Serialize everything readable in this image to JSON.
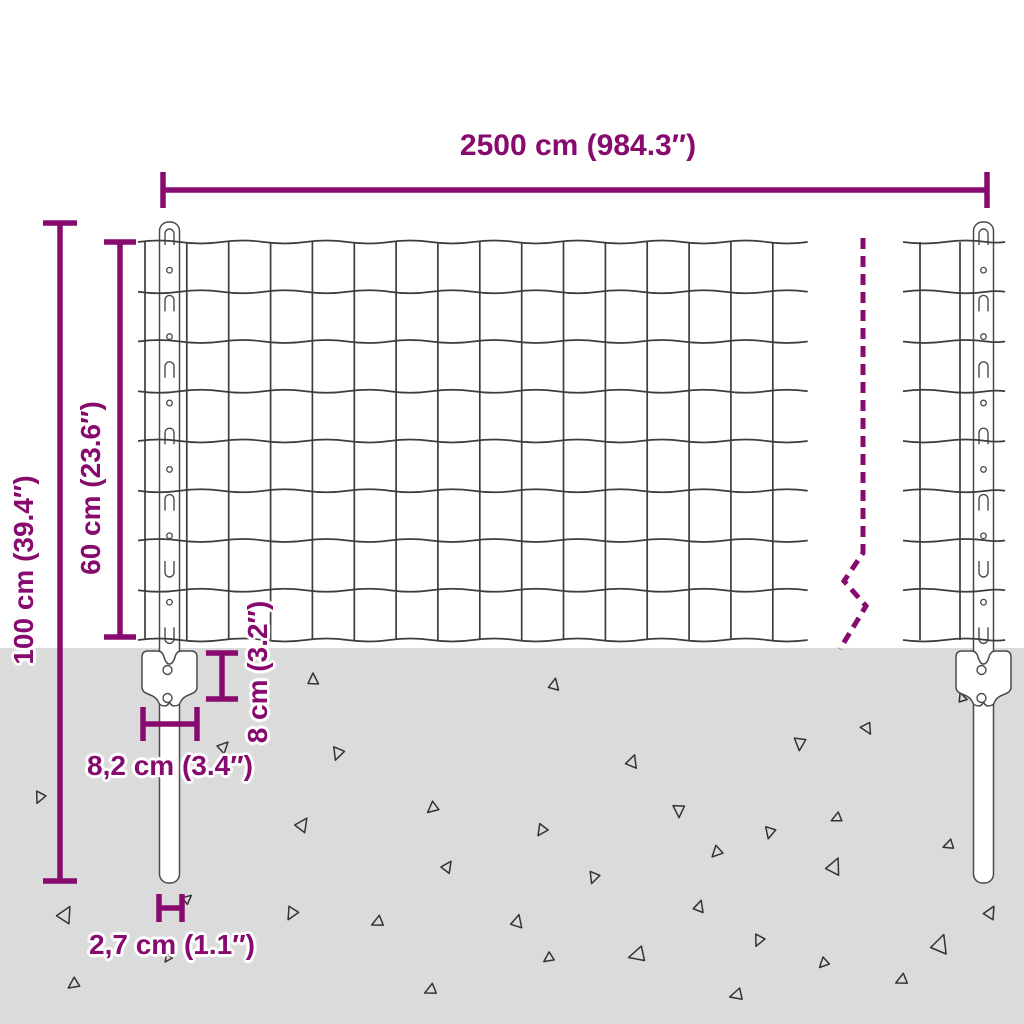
{
  "diagram": {
    "title": "fence-panel-with-posts-dimension-diagram",
    "labels": {
      "width": "2500 cm (984.3″)",
      "total_height": "100 cm (39.4″)",
      "mesh_height": "60 cm (23.6″)",
      "plate_height": "8 cm (3.2″)",
      "plate_width": "8,2 cm (3.4″)",
      "post_width": "2,7 cm (1.1″)"
    },
    "colors": {
      "dimension": "#870a6e",
      "wire": "#3d3d3d",
      "outline": "#4a4a4a",
      "ground": "#dbdbdb",
      "background": "#ffffff",
      "triangle": "#333333"
    },
    "geometry": {
      "ground_top": 648,
      "mesh": {
        "row_y0": 242,
        "row_gap": 49.75,
        "row_count": 9,
        "left": {
          "x0": 138,
          "x1": 807,
          "v_x0": 145,
          "v_gap": 41.85,
          "v_count": 16
        },
        "right": {
          "x0": 903,
          "x1": 1005,
          "verticals": [
            920,
            960
          ]
        },
        "wave_cell": 41.85,
        "wave_amp": 3
      },
      "posts": [
        {
          "cx": 169.5,
          "w": 20,
          "top": 222,
          "bottom": 883
        },
        {
          "cx": 983.5,
          "w": 20,
          "top": 222,
          "bottom": 883
        }
      ],
      "slots": {
        "y0": 237,
        "gap": 33.2,
        "count": 13,
        "flip_below_y": 550
      },
      "brackets": [
        {
          "cx": 169.5
        },
        {
          "cx": 983.5
        }
      ],
      "break_line": {
        "points": [
          [
            863,
            238
          ],
          [
            863,
            553
          ],
          [
            844,
            581
          ],
          [
            866,
            606
          ],
          [
            840,
            649
          ]
        ],
        "dash": "11 7"
      },
      "dimensions": {
        "width": {
          "o": "h",
          "y": 190,
          "a": 163,
          "b": 987,
          "t": 18
        },
        "total_height": {
          "o": "v",
          "x": 60,
          "a": 223,
          "b": 881,
          "t": 17
        },
        "mesh_height": {
          "o": "v",
          "x": 120,
          "a": 242,
          "b": 637,
          "t": 16
        },
        "plate_height": {
          "o": "v",
          "x": 222,
          "a": 653,
          "b": 699,
          "t": 16
        },
        "plate_width": {
          "o": "h",
          "y": 724,
          "a": 143,
          "b": 197,
          "t": 17
        },
        "post_width": {
          "o": "h",
          "y": 908,
          "a": 159,
          "b": 182,
          "t": 14
        }
      },
      "triangles": [
        {
          "x": 313,
          "y": 680,
          "s": 10,
          "r": 0
        },
        {
          "x": 554,
          "y": 685,
          "s": 10,
          "r": 12
        },
        {
          "x": 962,
          "y": 698,
          "s": 8,
          "r": -20
        },
        {
          "x": 867,
          "y": 728,
          "s": 10,
          "r": 150
        },
        {
          "x": 800,
          "y": 743,
          "s": 11,
          "r": 185
        },
        {
          "x": 338,
          "y": 753,
          "s": 11,
          "r": 200
        },
        {
          "x": 223,
          "y": 747,
          "s": 10,
          "r": 45
        },
        {
          "x": 632,
          "y": 762,
          "s": 11,
          "r": 20
        },
        {
          "x": 40,
          "y": 797,
          "s": 10,
          "r": 205
        },
        {
          "x": 433,
          "y": 808,
          "s": 10,
          "r": 230
        },
        {
          "x": 679,
          "y": 810,
          "s": 11,
          "r": 180
        },
        {
          "x": 837,
          "y": 818,
          "s": 9,
          "r": 245
        },
        {
          "x": 542,
          "y": 830,
          "s": 10,
          "r": 215
        },
        {
          "x": 770,
          "y": 832,
          "s": 10,
          "r": 195
        },
        {
          "x": 302,
          "y": 825,
          "s": 12,
          "r": 35
        },
        {
          "x": 717,
          "y": 852,
          "s": 10,
          "r": 225
        },
        {
          "x": 949,
          "y": 845,
          "s": 9,
          "r": 250
        },
        {
          "x": 65,
          "y": 915,
          "s": 14,
          "r": 30
        },
        {
          "x": 292,
          "y": 913,
          "s": 11,
          "r": 210
        },
        {
          "x": 378,
          "y": 922,
          "s": 10,
          "r": 245
        },
        {
          "x": 594,
          "y": 877,
          "s": 10,
          "r": 200
        },
        {
          "x": 834,
          "y": 867,
          "s": 14,
          "r": 25
        },
        {
          "x": 517,
          "y": 922,
          "s": 11,
          "r": 15
        },
        {
          "x": 990,
          "y": 913,
          "s": 11,
          "r": 30
        },
        {
          "x": 759,
          "y": 940,
          "s": 10,
          "r": 205
        },
        {
          "x": 940,
          "y": 945,
          "s": 16,
          "r": 20
        },
        {
          "x": 549,
          "y": 958,
          "s": 9,
          "r": 235
        },
        {
          "x": 638,
          "y": 955,
          "s": 14,
          "r": 255
        },
        {
          "x": 824,
          "y": 963,
          "s": 9,
          "r": 225
        },
        {
          "x": 902,
          "y": 980,
          "s": 10,
          "r": 245
        },
        {
          "x": 737,
          "y": 995,
          "s": 11,
          "r": 255
        },
        {
          "x": 74,
          "y": 984,
          "s": 10,
          "r": 235
        },
        {
          "x": 431,
          "y": 990,
          "s": 10,
          "r": 245
        },
        {
          "x": 168,
          "y": 958,
          "s": 7,
          "r": 215
        },
        {
          "x": 187,
          "y": 899,
          "s": 8,
          "r": 50
        },
        {
          "x": 447,
          "y": 867,
          "s": 10,
          "r": 35
        },
        {
          "x": 699,
          "y": 907,
          "s": 10,
          "r": 18
        }
      ]
    }
  }
}
